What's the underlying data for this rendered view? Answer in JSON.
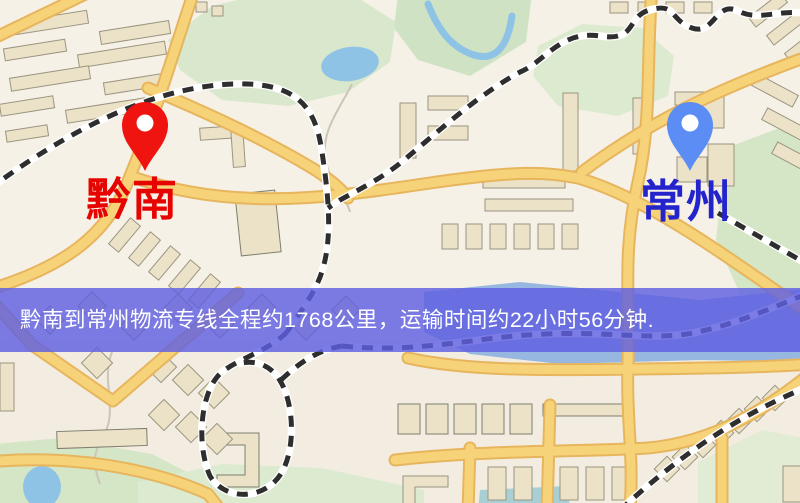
{
  "map": {
    "origin_marker": {
      "name": "黔南",
      "pin_color": "#ef1410",
      "label_color": "#e60400"
    },
    "destination_marker": {
      "name": "常州",
      "pin_color": "#5b8df5",
      "label_color": "#2424cd"
    }
  },
  "banner": {
    "text": "黔南到常州物流专线全程约1768公里，运输时间约22小时56分钟.",
    "background_color": "#5f5fe1",
    "text_color": "#ffffff"
  },
  "colors": {
    "map_background": "#f6f1e7",
    "road_fill": "#f6d379",
    "road_casing": "#e7b55d",
    "park_green": "#d9e8cc",
    "water_blue": "#9bc0e4",
    "building_fill": "#ece2c8",
    "building_stroke": "#9a9480",
    "railway_dark": "#2e2e2e"
  }
}
